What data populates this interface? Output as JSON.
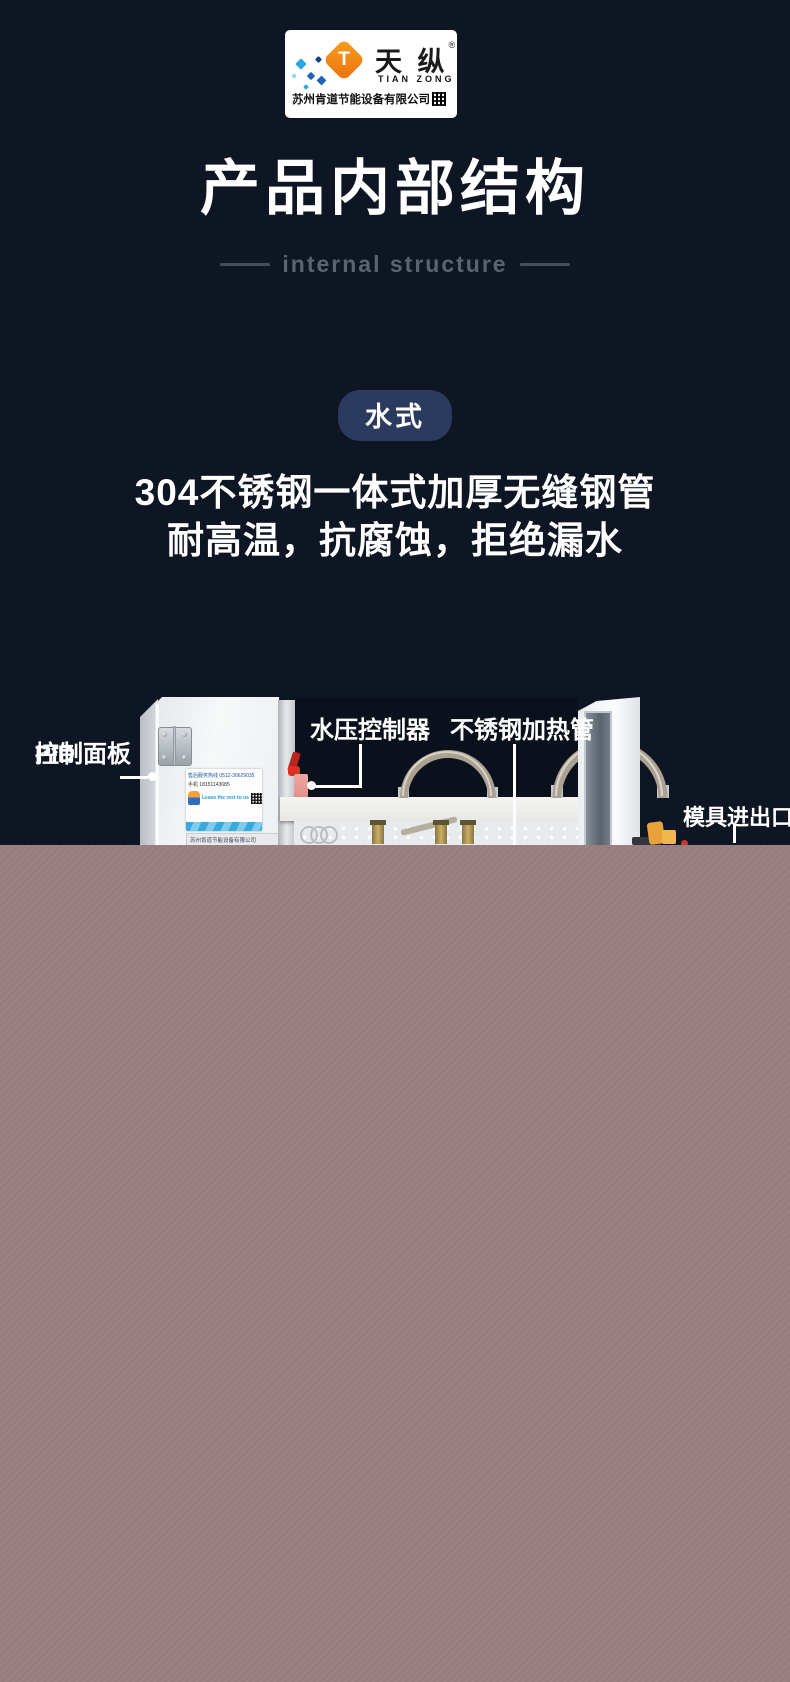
{
  "logo": {
    "brand_cn": "天 纵",
    "registered_mark": "®",
    "brand_en": "TIAN ZONG",
    "brand_initial": "T",
    "company": "苏州肯道节能设备有限公司"
  },
  "header": {
    "title": "产品内部结构",
    "subtitle": "internal structure"
  },
  "badge": {
    "label": "水式"
  },
  "description": {
    "line1": "304不锈钢一体式加厚无缝钢管",
    "line2": "耐高温，抗腐蚀，拒绝漏水"
  },
  "callouts": {
    "pid_line1": "PID",
    "pid_line2": "控制面板",
    "water_pressure": "水压控制器",
    "heating_tube": "不锈钢加热管",
    "mold_ports": "模具进出口"
  },
  "machine_sticker": {
    "hotline": "售后服务热线 0512-36629035",
    "mobile": "手机 18151143685",
    "slogan": "Leave the rest to us",
    "plate": "苏州肯道节能设备有限公司"
  },
  "colors": {
    "background": "#0e1523",
    "badge_bg": "#2b3a5f",
    "subtitle_gray": "#5b6270",
    "bottom_block": "#9b7f80",
    "logo_orange": "#f6a11c",
    "logo_blue": "#1f63b5"
  }
}
